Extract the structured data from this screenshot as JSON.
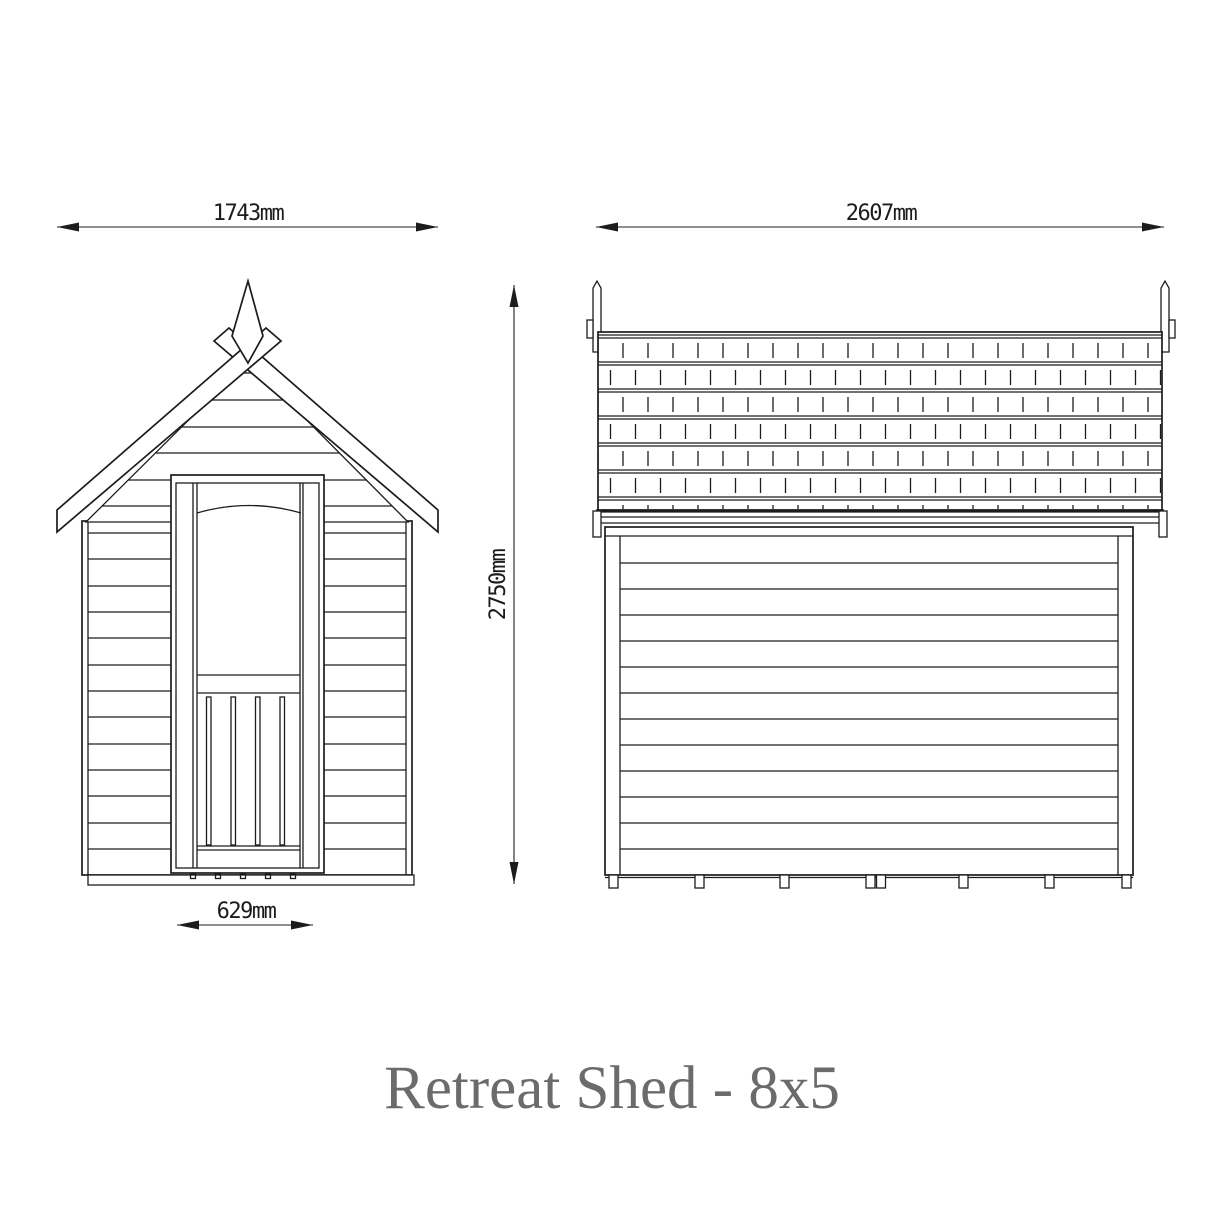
{
  "title": "Retreat Shed - 8x5",
  "dimensions": {
    "front_width": "1743mm",
    "side_width": "2607mm",
    "overall_height": "2750mm",
    "door_width": "629mm"
  },
  "colors": {
    "line": "#1c1c1c",
    "title": "#6b6b6b",
    "background": "#ffffff"
  }
}
